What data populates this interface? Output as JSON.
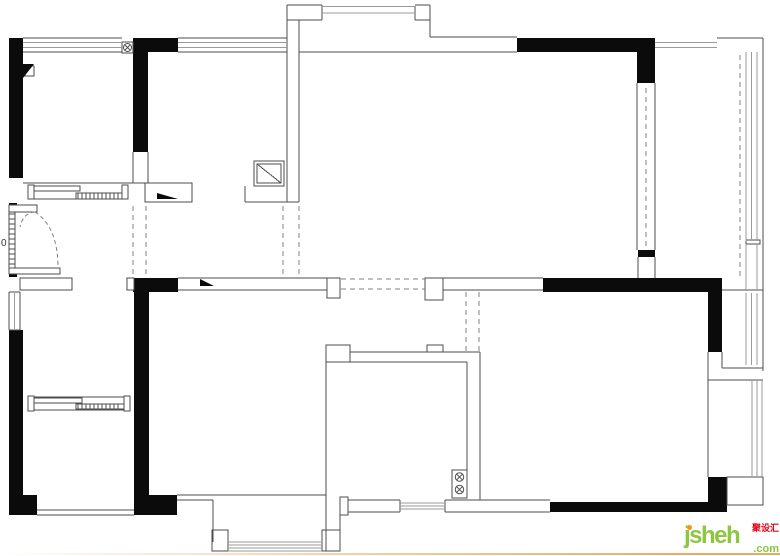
{
  "watermark": {
    "brand": "jsheh",
    "tld": ".com",
    "cn": "聚设汇",
    "green": "#8dc63f",
    "orange": "#f7941d",
    "red": "#e60012"
  },
  "bottom_line_color": "#eda75f",
  "floorplan": {
    "ink": "#0b0b0b",
    "stroke": "#4d4d4d",
    "window_color": "#9a9a9a",
    "dash_color": "#808080",
    "label_color": "#333333",
    "blacks": [
      [
        9,
        38,
        14,
        140
      ],
      [
        133,
        38,
        15,
        114
      ],
      [
        133,
        38,
        45,
        14
      ],
      [
        517,
        38,
        138,
        14
      ],
      [
        637,
        52,
        18,
        31
      ],
      [
        638,
        250,
        17,
        7
      ],
      [
        133,
        278,
        45,
        14
      ],
      [
        134,
        278,
        15,
        237
      ],
      [
        134,
        495,
        43,
        20
      ],
      [
        9,
        330,
        14,
        185
      ],
      [
        9,
        495,
        28,
        20
      ],
      [
        9,
        203,
        8,
        7
      ],
      [
        9,
        270,
        8,
        7
      ],
      [
        543,
        278,
        179,
        14
      ],
      [
        708,
        278,
        14,
        74
      ],
      [
        550,
        502,
        177,
        10
      ],
      [
        708,
        477,
        19,
        35
      ]
    ],
    "whites": [
      [
        9,
        205,
        28,
        7
      ],
      [
        9,
        268,
        51,
        6
      ],
      [
        20,
        278,
        52,
        12
      ],
      [
        127,
        278,
        7,
        12
      ],
      [
        145,
        183,
        47,
        19
      ],
      [
        28,
        185,
        6,
        14
      ],
      [
        122,
        185,
        6,
        14
      ],
      [
        34,
        186,
        46,
        5
      ],
      [
        76,
        193,
        46,
        6
      ],
      [
        28,
        396,
        6,
        15
      ],
      [
        124,
        396,
        6,
        15
      ],
      [
        34,
        398,
        48,
        5
      ],
      [
        76,
        404,
        48,
        5
      ],
      [
        254,
        161,
        30,
        25
      ],
      [
        257,
        164,
        24,
        19
      ],
      [
        122,
        42,
        11,
        11
      ],
      [
        25,
        66,
        9,
        10
      ],
      [
        427,
        345,
        16,
        7
      ],
      [
        326,
        345,
        24,
        17
      ],
      [
        452,
        470,
        15,
        28
      ],
      [
        340,
        497,
        8,
        18
      ],
      [
        327,
        278,
        13,
        20
      ],
      [
        425,
        278,
        18,
        22
      ],
      [
        212,
        530,
        16,
        21
      ],
      [
        322,
        530,
        18,
        21
      ],
      [
        746,
        240,
        14,
        4
      ],
      [
        727,
        477,
        36,
        28
      ]
    ],
    "lines": [
      [
        23,
        38,
        122,
        38
      ],
      [
        23,
        52,
        122,
        52
      ],
      [
        178,
        38,
        287,
        38
      ],
      [
        178,
        52,
        287,
        52
      ],
      [
        287,
        5,
        287,
        202
      ],
      [
        287,
        5,
        322,
        5
      ],
      [
        322,
        5,
        322,
        20
      ],
      [
        287,
        20,
        322,
        20
      ],
      [
        415,
        5,
        430,
        5
      ],
      [
        415,
        6,
        415,
        20
      ],
      [
        415,
        20,
        430,
        20
      ],
      [
        430,
        5,
        430,
        37
      ],
      [
        430,
        37,
        517,
        37
      ],
      [
        299,
        52,
        517,
        52
      ],
      [
        299,
        20,
        299,
        202
      ],
      [
        245,
        186,
        245,
        202
      ],
      [
        245,
        202,
        299,
        202
      ],
      [
        257,
        164,
        281,
        183
      ],
      [
        23,
        183,
        145,
        183
      ],
      [
        133,
        152,
        133,
        183
      ],
      [
        148,
        152,
        148,
        183
      ],
      [
        34,
        199,
        122,
        199
      ],
      [
        9,
        212,
        9,
        268
      ],
      [
        15,
        212,
        15,
        268
      ],
      [
        9,
        292,
        9,
        330
      ],
      [
        20,
        292,
        20,
        330
      ],
      [
        9,
        292,
        20,
        292
      ],
      [
        9,
        330,
        20,
        330
      ],
      [
        37,
        510,
        134,
        510
      ],
      [
        37,
        515,
        134,
        515
      ],
      [
        34,
        397,
        124,
        397
      ],
      [
        34,
        410,
        124,
        410
      ],
      [
        637,
        83,
        637,
        250
      ],
      [
        655,
        83,
        655,
        250
      ],
      [
        638,
        257,
        638,
        278
      ],
      [
        655,
        257,
        655,
        278
      ],
      [
        717,
        38,
        763,
        38
      ],
      [
        763,
        38,
        763,
        371
      ],
      [
        722,
        290,
        763,
        290
      ],
      [
        722,
        352,
        722,
        368
      ],
      [
        722,
        368,
        763,
        368
      ],
      [
        708,
        380,
        763,
        380
      ],
      [
        708,
        352,
        708,
        477
      ],
      [
        727,
        477,
        763,
        477
      ],
      [
        326,
        362,
        326,
        551
      ],
      [
        340,
        515,
        340,
        530
      ],
      [
        350,
        352,
        427,
        352
      ],
      [
        443,
        352,
        480,
        352
      ],
      [
        350,
        362,
        467,
        362
      ],
      [
        467,
        362,
        467,
        470
      ],
      [
        480,
        352,
        480,
        500
      ],
      [
        348,
        500,
        400,
        500
      ],
      [
        348,
        512,
        400,
        512
      ],
      [
        400,
        500,
        400,
        512
      ],
      [
        445,
        500,
        445,
        512
      ],
      [
        445,
        500,
        550,
        500
      ],
      [
        445,
        512,
        550,
        512
      ],
      [
        177,
        495,
        326,
        495
      ],
      [
        177,
        500,
        213,
        500
      ],
      [
        213,
        500,
        213,
        542
      ],
      [
        178,
        278,
        327,
        278
      ],
      [
        178,
        290,
        327,
        290
      ],
      [
        443,
        278,
        543,
        278
      ],
      [
        443,
        290,
        543,
        290
      ]
    ],
    "grays": [
      [
        23,
        42.5,
        122,
        42.5
      ],
      [
        23,
        47.5,
        122,
        47.5
      ],
      [
        178,
        42.5,
        287,
        42.5
      ],
      [
        178,
        47.5,
        287,
        47.5
      ],
      [
        322,
        6.5,
        415,
        6.5
      ],
      [
        322,
        13,
        415,
        13
      ],
      [
        655,
        42.5,
        717,
        42.5
      ],
      [
        655,
        47.5,
        717,
        47.5
      ],
      [
        746,
        52,
        746,
        241
      ],
      [
        751.5,
        52,
        751.5,
        241
      ],
      [
        757,
        52,
        757,
        241
      ],
      [
        746,
        244,
        746,
        290
      ],
      [
        757,
        244,
        757,
        290
      ],
      [
        746,
        293,
        746,
        365
      ],
      [
        751.5,
        293,
        751.5,
        365
      ],
      [
        757,
        293,
        757,
        365
      ],
      [
        752,
        380,
        752,
        477
      ],
      [
        757,
        380,
        757,
        477
      ],
      [
        762,
        380,
        762,
        477
      ],
      [
        400,
        503,
        445,
        503
      ],
      [
        400,
        506,
        445,
        506
      ],
      [
        400,
        509,
        445,
        509
      ],
      [
        228,
        542,
        322,
        542
      ],
      [
        228,
        545,
        322,
        545
      ],
      [
        228,
        548,
        322,
        548
      ],
      [
        228,
        551,
        322,
        551
      ],
      [
        14.5,
        292,
        14.5,
        330
      ]
    ],
    "dashed": [
      [
        133,
        206,
        133,
        276
      ],
      [
        146,
        206,
        146,
        276
      ],
      [
        283,
        206,
        283,
        274
      ],
      [
        299,
        206,
        299,
        274
      ],
      [
        646,
        88,
        646,
        248
      ],
      [
        740,
        55,
        740,
        276
      ],
      [
        341,
        279,
        425,
        279
      ],
      [
        341,
        289,
        425,
        289
      ],
      [
        466,
        292,
        466,
        352
      ],
      [
        479,
        292,
        479,
        352
      ]
    ],
    "triangles": [
      [
        [
          23,
          64
        ],
        [
          34,
          64
        ],
        [
          23,
          78
        ]
      ],
      [
        [
          157,
          193
        ],
        [
          178,
          199
        ],
        [
          157,
          199
        ]
      ],
      [
        [
          200,
          279
        ],
        [
          214,
          286
        ],
        [
          200,
          286
        ]
      ]
    ],
    "arcs": [
      "M 35 212 Q 57 226 58 265",
      "M 35 212 Q 23 213 20 227"
    ],
    "xsymbols": [
      {
        "cx": 127.5,
        "cy": 47.5,
        "r": 4
      },
      {
        "cx": 459.5,
        "cy": 477,
        "r": 4.2
      },
      {
        "cx": 459.5,
        "cy": 489.5,
        "r": 4.2
      }
    ],
    "hatches": [
      {
        "x": 78,
        "y": 193.5,
        "len": 5,
        "step": 4,
        "count": 11,
        "dir": "v"
      },
      {
        "x": 78,
        "y": 404.5,
        "len": 4,
        "step": 4,
        "count": 11,
        "dir": "v"
      },
      {
        "x": 9.5,
        "y": 214,
        "len": 5,
        "step": 5,
        "count": 11,
        "dir": "h"
      }
    ],
    "texts": [
      {
        "x": 1,
        "y": 246,
        "t": "0",
        "size": 10
      }
    ]
  }
}
